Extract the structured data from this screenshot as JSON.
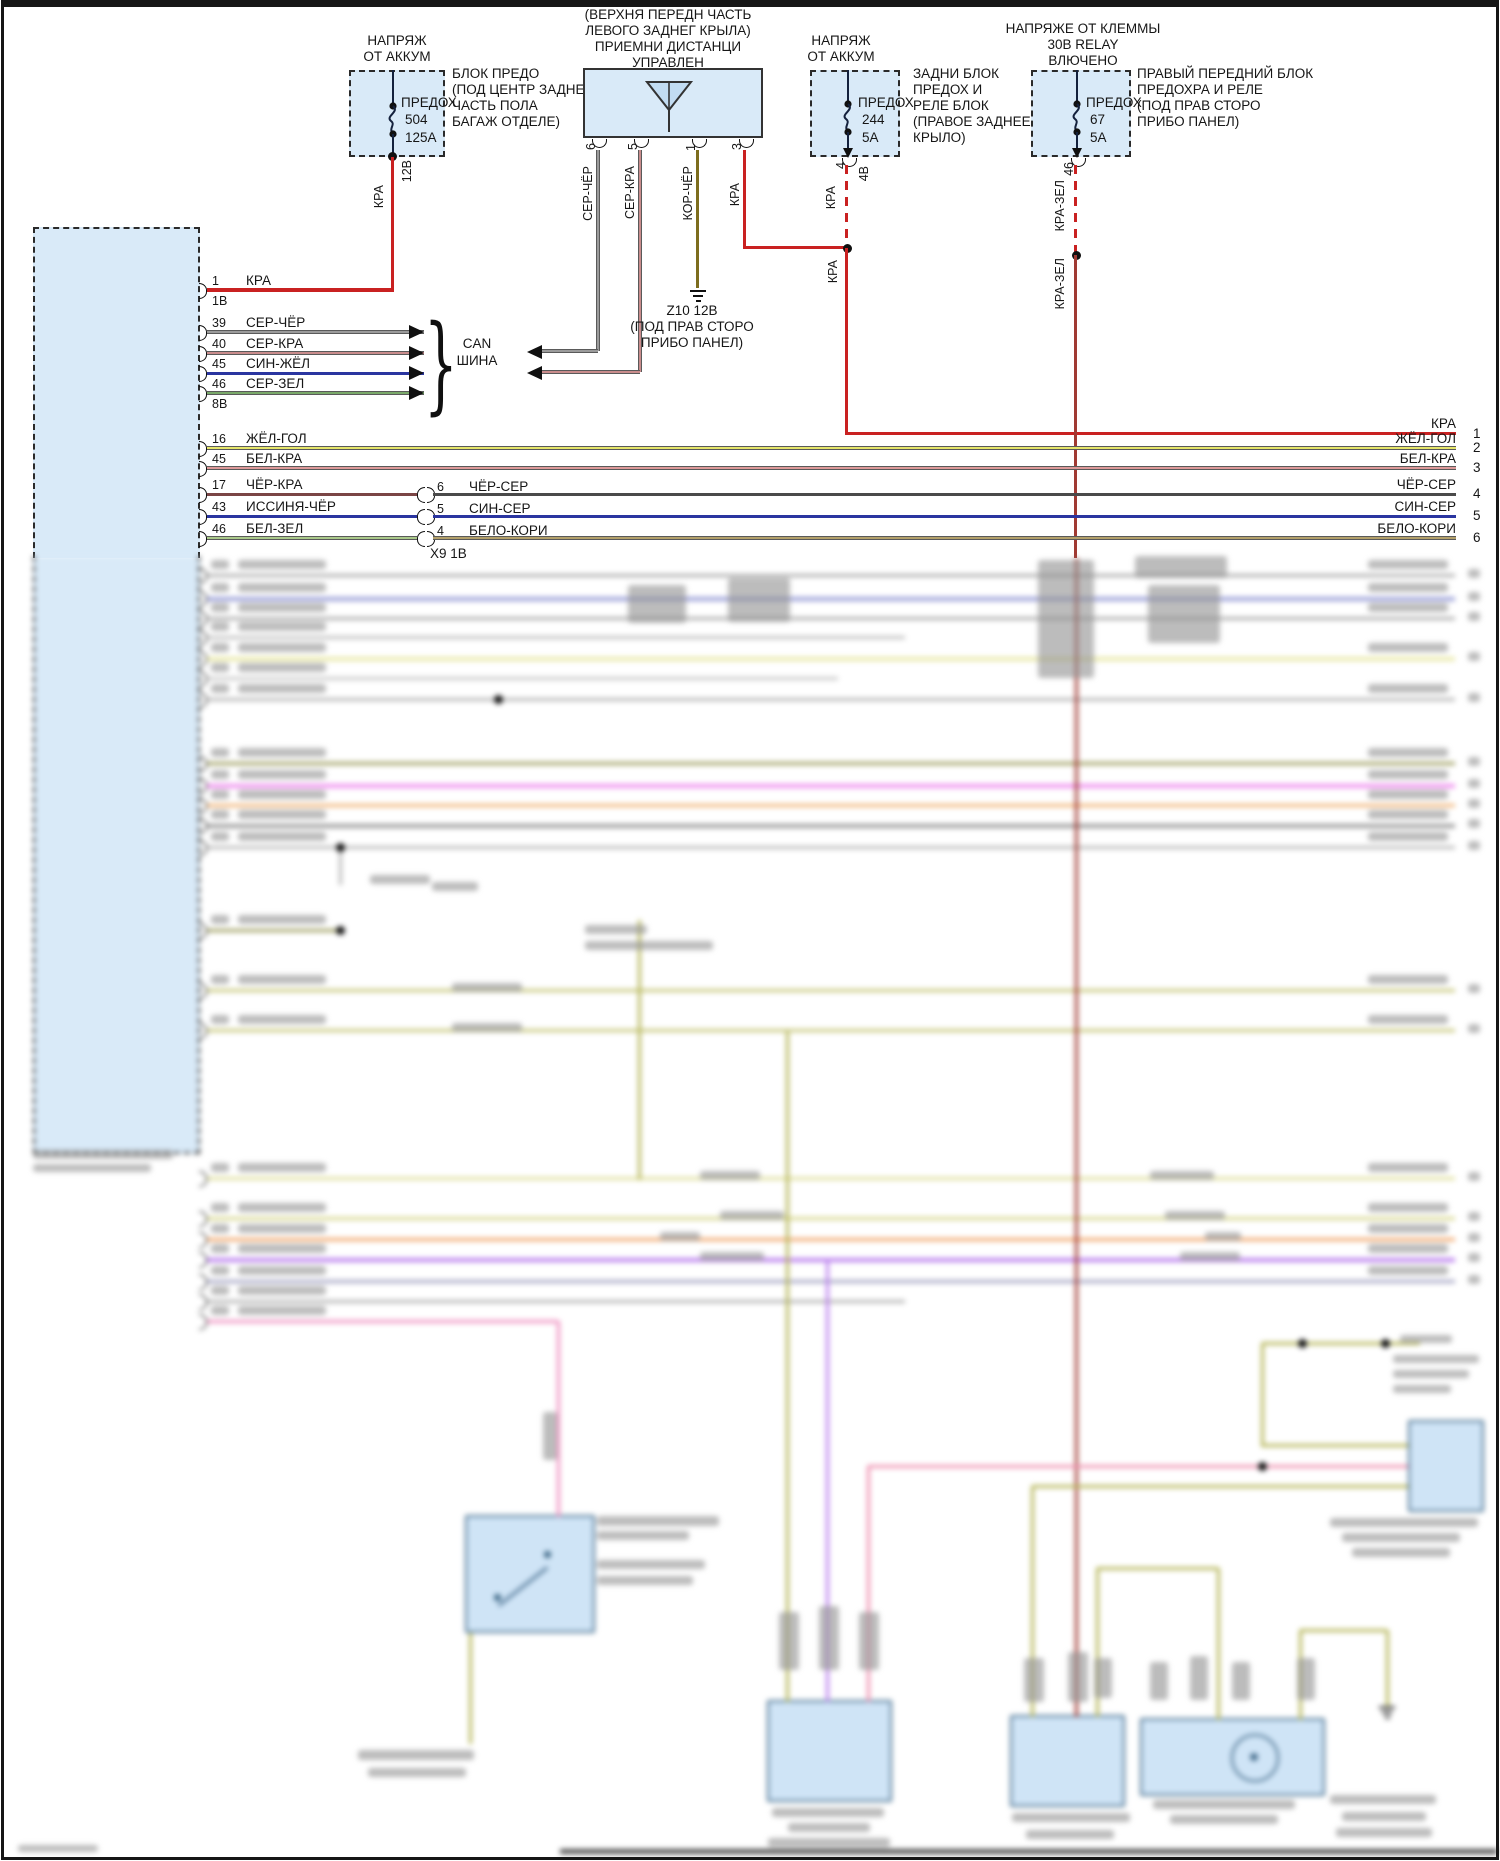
{
  "diagram": {
    "sources": [
      {
        "title": [
          "НАПРЯЖ",
          "ОТ АККУМ"
        ],
        "fuse_label": "ПРЕДОХ",
        "fuse_number": "504",
        "fuse_rating": "125А",
        "location": [
          "БЛОК ПРЕДО",
          "(ПОД ЦЕНТР ЗАДНЕ",
          "ЧАСТЬ ПОЛА",
          "БАГАЖ ОТДЕЛЕ)"
        ],
        "wire_label": "КРА",
        "voltage_label": "12В"
      },
      {
        "title": [
          "НАПРЯЖ",
          "ОТ АККУМ"
        ],
        "fuse_label": "ПРЕДОХ",
        "fuse_number": "244",
        "fuse_rating": "5А",
        "location": [
          "ЗАДНИ БЛОК",
          "ПРЕДОХ И",
          "РЕЛЕ БЛОК",
          "(ПРАВОЕ ЗАДНЕЕ",
          "КРЫЛО)"
        ],
        "pin": "4",
        "pin_label": "4В",
        "wire_label": "КРА",
        "wire_label2": "КРА"
      },
      {
        "title": [
          "НАПРЯЖЕ ОТ КЛЕММЫ",
          "30В RELAY",
          "ВЛЮЧЕНО"
        ],
        "fuse_label": "ПРЕДОХ",
        "fuse_number": "67",
        "fuse_rating": "5А",
        "location": [
          "ПРАВЫЙ ПЕРЕДНИЙ БЛОК",
          "ПРЕДОХРА И РЕЛЕ",
          "(ПОД ПРАВ СТОРО",
          "ПРИБО ПАНЕЛ)"
        ],
        "pin": "46",
        "wire_label": "КРА-ЗЕЛ",
        "wire_label2": "КРА-ЗЕЛ"
      }
    ],
    "receiver": {
      "title": [
        "(ВЕРХНЯ ПЕРЕДН ЧАСТЬ",
        "ЛЕВОГО ЗАДНЕГ КРЫЛА)",
        "ПРИЕМНИ ДИСТАНЦИ",
        "УПРАВЛЕН"
      ],
      "pins": [
        "6",
        "5",
        "1",
        "3"
      ],
      "wires": [
        "СЕР-ЧЁР",
        "СЕР-КРА",
        "КОР-ЧЁР",
        "КРА"
      ]
    },
    "ground": {
      "lines": [
        "Z10 12В",
        "(ПОД ПРАВ СТОРО",
        "ПРИБО ПАНЕЛ)"
      ]
    },
    "can_bus": {
      "label": [
        "CAN",
        "ШИНА"
      ]
    },
    "connector_x9": {
      "label": "Х9 1В"
    },
    "right_edge": {
      "wire": "КРА",
      "pin": "1"
    },
    "ecu": {
      "rows": [
        {
          "pin": "1",
          "wire": "КРА",
          "sub": "1В",
          "y": 290,
          "color": "red",
          "shape": "short"
        },
        {
          "pin": "39",
          "wire": "СЕР-ЧЁР",
          "y": 332,
          "color": "gray",
          "outlined": true,
          "shape": "can"
        },
        {
          "pin": "40",
          "wire": "СЕР-КРА",
          "y": 353,
          "color": "pinkred",
          "outlined": true,
          "shape": "can"
        },
        {
          "pin": "45",
          "wire": "СИН-ЖЁЛ",
          "y": 373,
          "color": "blue",
          "shape": "can"
        },
        {
          "pin": "46",
          "wire": "СЕР-ЗЕЛ",
          "sub": "8В",
          "y": 393,
          "color": "green",
          "outlined": true,
          "shape": "can"
        },
        {
          "pin": "16",
          "wire": "ЖЁЛ-ГОЛ",
          "y": 448,
          "color": "yellow",
          "outlined": true,
          "shape": "full",
          "right_wire": "ЖЁЛ-ГОЛ",
          "right_pin": "2"
        },
        {
          "pin": "45",
          "wire": "БЕЛ-КРА",
          "y": 468,
          "color": "pink",
          "outlined": true,
          "shape": "full",
          "right_wire": "БЕЛ-КРА",
          "right_pin": "3"
        },
        {
          "pin": "17",
          "wire": "ЧЁР-КРА",
          "y": 494,
          "color": "brownred",
          "shape": "split",
          "split_pin": "6",
          "split_wire": "ЧЁР-СЕР",
          "split_color": "darkgray",
          "right_wire": "ЧЁР-СЕР",
          "right_pin": "4"
        },
        {
          "pin": "43",
          "wire": "ИССИНЯ-ЧЁР",
          "y": 516,
          "color": "blue",
          "shape": "split",
          "split_pin": "5",
          "split_wire": "СИН-СЕР",
          "split_color": "blue",
          "right_wire": "СИН-СЕР",
          "right_pin": "5"
        },
        {
          "pin": "46",
          "wire": "БЕЛ-ЗЕЛ",
          "y": 538,
          "color": "lightgreen",
          "outlined": true,
          "shape": "split",
          "split_pin": "4",
          "split_wire": "БЕЛО-КОРИ",
          "split_color": "tan",
          "split_outlined": true,
          "right_wire": "БЕЛО-КОРИ",
          "right_pin": "6"
        }
      ]
    }
  },
  "colors": {
    "red": "#c92121",
    "darkred": "#a03a33",
    "gray": "#9b9b9b",
    "pinkred": "#c98c8c",
    "olive": "#7d6d1e",
    "blue": "#2a35a0",
    "green": "#7aa96a",
    "yellow": "#e5e56a",
    "pink": "#dd9999",
    "brownred": "#7a4545",
    "darkgray": "#4a4a4a",
    "lightgreen": "#aac98a",
    "tan": "#b3a06a",
    "boxfill": "#d9eaf8"
  },
  "blurred": {
    "rows": [
      [
        575,
        1455,
        "#a9a9a9",
        0
      ],
      [
        598,
        1455,
        "#9ba0d8",
        1
      ],
      [
        618,
        1455,
        "#a9a9a9",
        0
      ],
      [
        637,
        905,
        "#bdbdbd",
        0
      ],
      [
        658,
        1455,
        "#e9e9a9",
        1
      ],
      [
        678,
        838,
        "#c6c6c6",
        0
      ],
      [
        699,
        1455,
        "#b3b3b3",
        0
      ],
      [
        763,
        1455,
        "#9a9a5a",
        0
      ],
      [
        785,
        1455,
        "#ef8fef",
        1
      ],
      [
        805,
        1455,
        "#f0b070",
        0
      ],
      [
        825,
        1455,
        "#9a9a9a",
        1
      ],
      [
        847,
        1455,
        "#b7b7b7",
        0
      ],
      [
        930,
        340,
        "#9a9a5a",
        0
      ],
      [
        990,
        1455,
        "#c5c578",
        0
      ],
      [
        1030,
        1455,
        "#c5c578",
        0
      ],
      [
        1178,
        1455,
        "#dede9a",
        0
      ],
      [
        1218,
        1455,
        "#d5d58a",
        0
      ],
      [
        1239,
        1455,
        "#f0a060",
        0
      ],
      [
        1259,
        1455,
        "#bb80ee",
        1
      ],
      [
        1281,
        1455,
        "#a0a0c0",
        0
      ],
      [
        1301,
        905,
        "#b0b0b0",
        0
      ],
      [
        1321,
        558,
        "#ee8fbf",
        0
      ]
    ],
    "verticals": [
      [
        639,
        920,
        1180,
        "#b5b558"
      ],
      [
        558,
        1321,
        1517,
        "#ee8fbf"
      ],
      [
        787,
        1032,
        1702,
        "#b5b558"
      ],
      [
        827,
        1261,
        1702,
        "#bb80ee"
      ],
      [
        868,
        1466,
        1702,
        "#ee8faf"
      ],
      [
        1032,
        1486,
        1717,
        "#b5b558"
      ],
      [
        1076,
        558,
        1717,
        "#a03a33"
      ],
      [
        1262,
        1343,
        1447,
        "#b5b558"
      ],
      [
        1097,
        1568,
        1717,
        "#b5b558"
      ],
      [
        1218,
        1568,
        1720,
        "#b5b558"
      ],
      [
        1300,
        1630,
        1720,
        "#b5b558"
      ],
      [
        1387,
        1630,
        1706,
        "#b5b558"
      ],
      [
        470,
        1633,
        1744,
        "#b5b558"
      ],
      [
        340,
        847,
        885,
        "#b7b7b7"
      ]
    ],
    "horizontals": [
      [
        1343,
        1262,
        1420,
        "#b5b558"
      ],
      [
        1445,
        1262,
        1408,
        "#b5b558"
      ],
      [
        1466,
        868,
        1408,
        "#ee8faf"
      ],
      [
        1486,
        1032,
        1408,
        "#b5b558"
      ],
      [
        1568,
        1097,
        1218,
        "#b5b558"
      ],
      [
        1630,
        1300,
        1387,
        "#b5b558"
      ]
    ],
    "dots": [
      [
        498,
        699
      ],
      [
        340,
        847
      ],
      [
        340,
        930
      ],
      [
        1262,
        1466
      ],
      [
        1302,
        1343
      ],
      [
        1385,
        1343
      ]
    ],
    "boxes": [
      [
        465,
        1515,
        130,
        118
      ],
      [
        767,
        1700,
        125,
        102
      ],
      [
        1010,
        1715,
        115,
        92
      ],
      [
        1140,
        1718,
        185,
        78
      ],
      [
        1408,
        1420,
        76,
        92
      ]
    ],
    "textblobs": [
      [
        628,
        585,
        58,
        38
      ],
      [
        728,
        578,
        62,
        44
      ],
      [
        1038,
        560,
        56,
        118
      ],
      [
        1135,
        556,
        92,
        22
      ],
      [
        1148,
        585,
        72,
        58
      ],
      [
        370,
        875,
        60,
        9
      ],
      [
        432,
        882,
        46,
        9
      ],
      [
        585,
        925,
        62,
        9
      ],
      [
        585,
        941,
        128,
        9
      ],
      [
        452,
        983,
        70,
        9
      ],
      [
        452,
        1023,
        70,
        9
      ],
      [
        700,
        1171,
        60,
        9
      ],
      [
        720,
        1211,
        64,
        9
      ],
      [
        660,
        1232,
        40,
        9
      ],
      [
        700,
        1252,
        64,
        9
      ],
      [
        1150,
        1171,
        64,
        9
      ],
      [
        1165,
        1211,
        60,
        9
      ],
      [
        1205,
        1232,
        36,
        9
      ],
      [
        1180,
        1252,
        60,
        9
      ],
      [
        1400,
        1335,
        52,
        8
      ],
      [
        1393,
        1355,
        86,
        8
      ],
      [
        1393,
        1370,
        76,
        8
      ],
      [
        1393,
        1385,
        58,
        8
      ],
      [
        1330,
        1518,
        148,
        9
      ],
      [
        1342,
        1533,
        118,
        9
      ],
      [
        1352,
        1548,
        98,
        9
      ],
      [
        543,
        1412,
        14,
        48
      ],
      [
        597,
        1516,
        122,
        10
      ],
      [
        597,
        1531,
        92,
        9
      ],
      [
        597,
        1560,
        108,
        9
      ],
      [
        597,
        1576,
        96,
        9
      ],
      [
        772,
        1808,
        112,
        9
      ],
      [
        788,
        1823,
        82,
        9
      ],
      [
        768,
        1838,
        122,
        9
      ],
      [
        1012,
        1813,
        118,
        9
      ],
      [
        1026,
        1830,
        88,
        9
      ],
      [
        1153,
        1800,
        142,
        9
      ],
      [
        1170,
        1815,
        108,
        9
      ],
      [
        1330,
        1795,
        106,
        9
      ],
      [
        1342,
        1812,
        84,
        9
      ],
      [
        1336,
        1828,
        96,
        9
      ],
      [
        33,
        1150,
        140,
        9
      ],
      [
        33,
        1164,
        118,
        8
      ],
      [
        18,
        1845,
        80,
        7
      ],
      [
        358,
        1750,
        116,
        10
      ],
      [
        368,
        1768,
        98,
        9
      ],
      [
        779,
        1612,
        20,
        58
      ],
      [
        819,
        1606,
        20,
        64
      ],
      [
        859,
        1612,
        20,
        58
      ],
      [
        1024,
        1658,
        20,
        44
      ],
      [
        1068,
        1652,
        20,
        50
      ],
      [
        1094,
        1658,
        18,
        40
      ],
      [
        1297,
        1658,
        18,
        42
      ],
      [
        1150,
        1662,
        18,
        38
      ],
      [
        1190,
        1656,
        18,
        44
      ],
      [
        1232,
        1662,
        18,
        38
      ]
    ],
    "bottom_bar": [
      560,
      1849,
      937,
      5,
      "#4f4f4f"
    ]
  }
}
